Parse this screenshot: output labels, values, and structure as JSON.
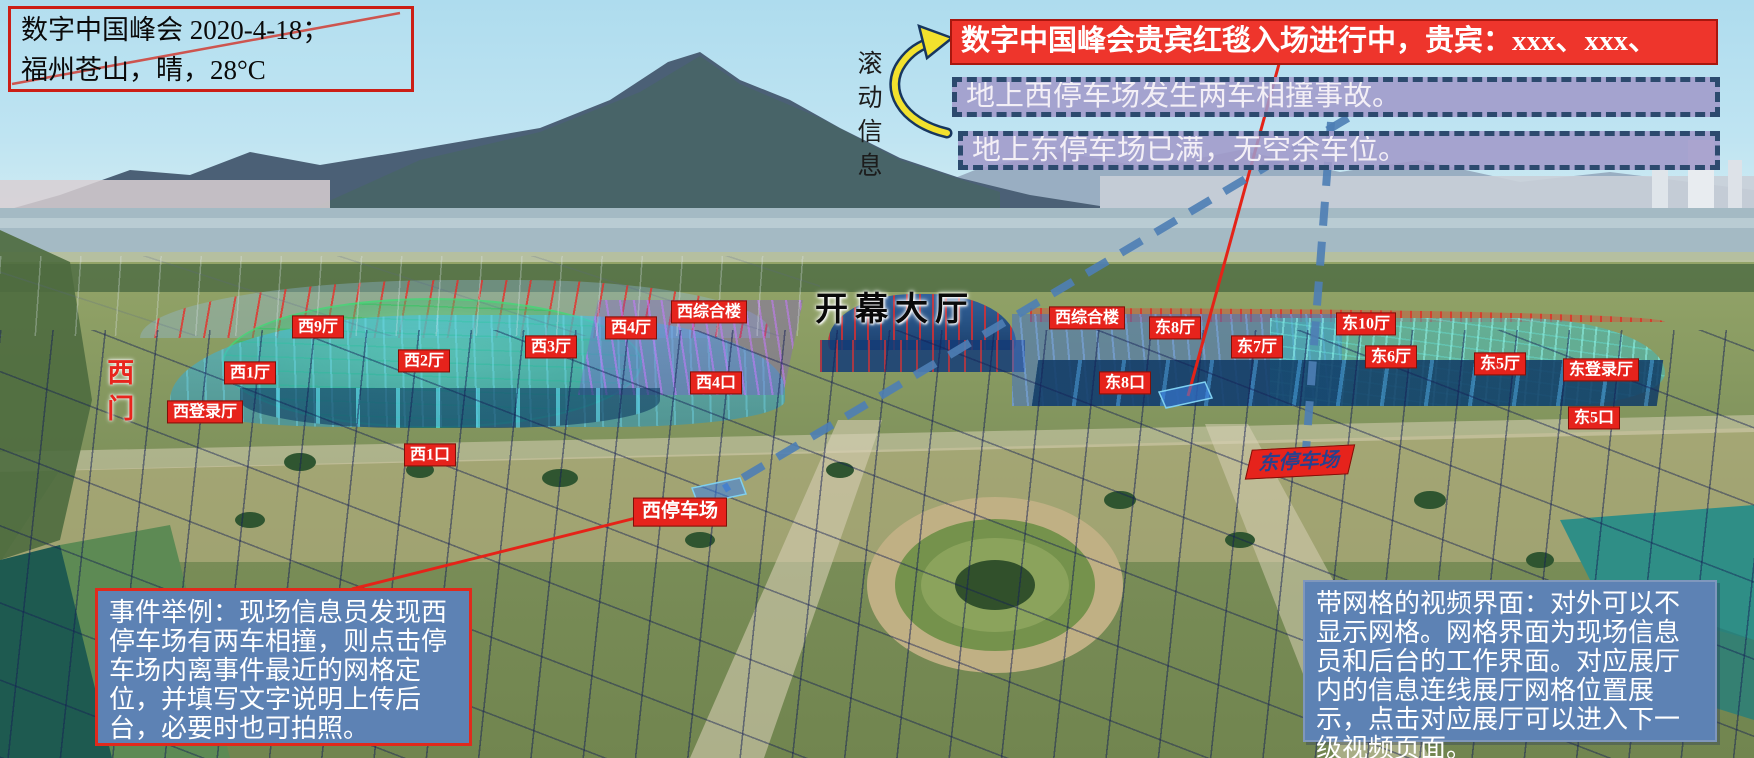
{
  "scene": {
    "title_box": {
      "line1": "数字中国峰会 2020-4-18；",
      "line2": "福州苍山，晴，28°C"
    }
  },
  "scroll_info": {
    "label": "滚动信息"
  },
  "banners": {
    "vip": {
      "text": "数字中国峰会贵宾红毯入场进行中，贵宾：xxx、xxx、"
    },
    "west_parking_alert": {
      "text": "地上西停车场发生两车相撞事故。"
    },
    "east_parking_alert": {
      "text": "地上东停车场已满，无空余车位。"
    }
  },
  "venue": {
    "labels": [
      {
        "id": "xi-9-ting",
        "text": "西9厅",
        "x": 318,
        "y": 327
      },
      {
        "id": "xi-2-ting",
        "text": "西2厅",
        "x": 424,
        "y": 361
      },
      {
        "id": "xi-1-ting",
        "text": "西1厅",
        "x": 250,
        "y": 373
      },
      {
        "id": "xi-denglu-ting",
        "text": "西登录厅",
        "x": 205,
        "y": 412
      },
      {
        "id": "xi-3-ting",
        "text": "西3厅",
        "x": 551,
        "y": 347
      },
      {
        "id": "xi-4-ting",
        "text": "西4厅",
        "x": 631,
        "y": 328
      },
      {
        "id": "xi-zonghe-lou",
        "text": "西综合楼",
        "x": 709,
        "y": 312
      },
      {
        "id": "xi-4-kou",
        "text": "西4口",
        "x": 716,
        "y": 383
      },
      {
        "id": "kaimu-dating",
        "text": "开幕大厅",
        "x": 895,
        "y": 311,
        "kind": "title"
      },
      {
        "id": "xi-zonghe-lou-2",
        "text": "西综合楼",
        "x": 1087,
        "y": 318
      },
      {
        "id": "dong-8-ting",
        "text": "东8厅",
        "x": 1175,
        "y": 328
      },
      {
        "id": "dong-8-kou",
        "text": "东8口",
        "x": 1125,
        "y": 383
      },
      {
        "id": "dong-7-ting",
        "text": "东7厅",
        "x": 1257,
        "y": 347
      },
      {
        "id": "dong-10-ting",
        "text": "东10厅",
        "x": 1366,
        "y": 324
      },
      {
        "id": "dong-6-ting",
        "text": "东6厅",
        "x": 1391,
        "y": 357
      },
      {
        "id": "dong-5-ting",
        "text": "东5厅",
        "x": 1500,
        "y": 364
      },
      {
        "id": "dong-denglu-ting",
        "text": "东登录厅",
        "x": 1601,
        "y": 370
      },
      {
        "id": "dong-5-kou",
        "text": "东5口",
        "x": 1594,
        "y": 418
      },
      {
        "id": "xi-1-kou",
        "text": "西1口",
        "x": 430,
        "y": 455
      },
      {
        "id": "xi-men",
        "text": "西门",
        "x": 118,
        "y": 394,
        "kind": "gate-vertical"
      },
      {
        "id": "xi-tingchechang",
        "text": "西停车场",
        "x": 680,
        "y": 512,
        "kind": "parking-west"
      },
      {
        "id": "dong-tingchechang",
        "text": "东停车场",
        "x": 1300,
        "y": 462,
        "kind": "parking-east"
      }
    ]
  },
  "notes": {
    "event_example": {
      "text": "事件举例：现场信息员发现西停车场有两车相撞，则点击停车场内离事件最近的网格定位，并填写文字说明上传后台，必要时也可拍照。"
    },
    "grid_info": {
      "text": "带网格的视频界面：对外可以不显示网格。网格界面为现场信息员和后台的工作界面。对应展厅内的信息连线展厅网格位置展示，点击对应展厅可以进入下一级视频页面。"
    }
  },
  "colors": {
    "alert_banner_red": "#ee352c",
    "notice_purple": "#a19ac9",
    "notice_dash_border": "#2c4a6e",
    "note_box_blue": "#5d82b4",
    "venue_label_red": "#e6231c",
    "connector_blue": "#4e7fb5",
    "connector_red": "#e42318",
    "arrow_yellow": "#f2e12d"
  }
}
